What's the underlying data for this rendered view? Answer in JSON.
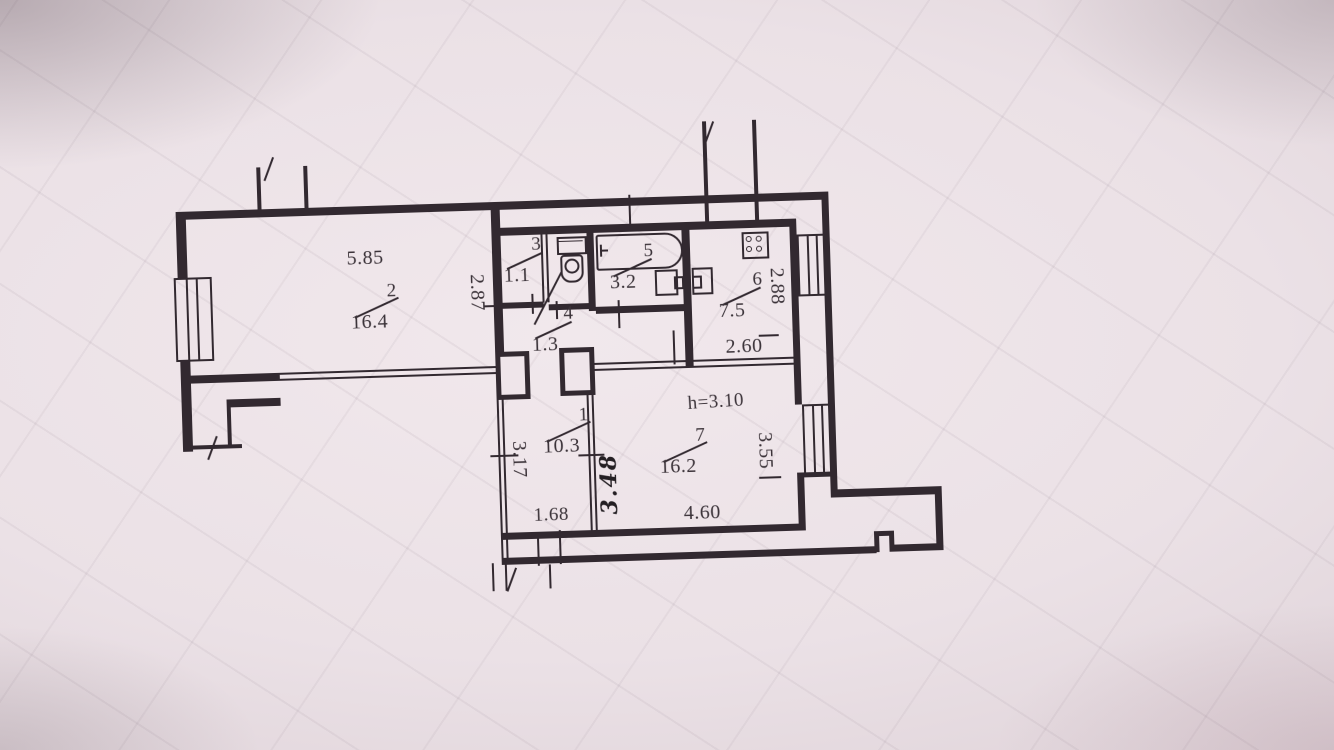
{
  "floor_plan": {
    "description": "Photographed BTI apartment floor plan sheet",
    "rooms": {
      "r1": {
        "number": "1",
        "area": "10.3"
      },
      "r2": {
        "number": "2",
        "area": "16.4"
      },
      "r3": {
        "number": "3",
        "area": "1.1"
      },
      "r4": {
        "number": "4",
        "area": "1.3"
      },
      "r5": {
        "number": "5",
        "area": "3.2"
      },
      "r6": {
        "number": "6",
        "area": "7.5"
      },
      "r7": {
        "number": "7",
        "area": "16.2"
      }
    },
    "dimensions": {
      "room2_width": "5.85",
      "room2_depth": "2.87",
      "kitchen_depth": "2.88",
      "kitchen_width": "2.60",
      "ceiling_height": "h=3.10",
      "room7_right": "3.55",
      "hall_depth": "3.17",
      "hall_width": "1.68",
      "room7_width": "4.60",
      "handwritten_note": "3.48"
    },
    "fixtures": [
      "toilet",
      "bathtub",
      "bath-sink",
      "kitchen-sink",
      "stove-4-burner"
    ],
    "symbols": [
      "window",
      "wall-break-mark",
      "door-opening-tick"
    ],
    "colors": {
      "ink": "#322930",
      "paper": "#ebe1e6"
    }
  }
}
